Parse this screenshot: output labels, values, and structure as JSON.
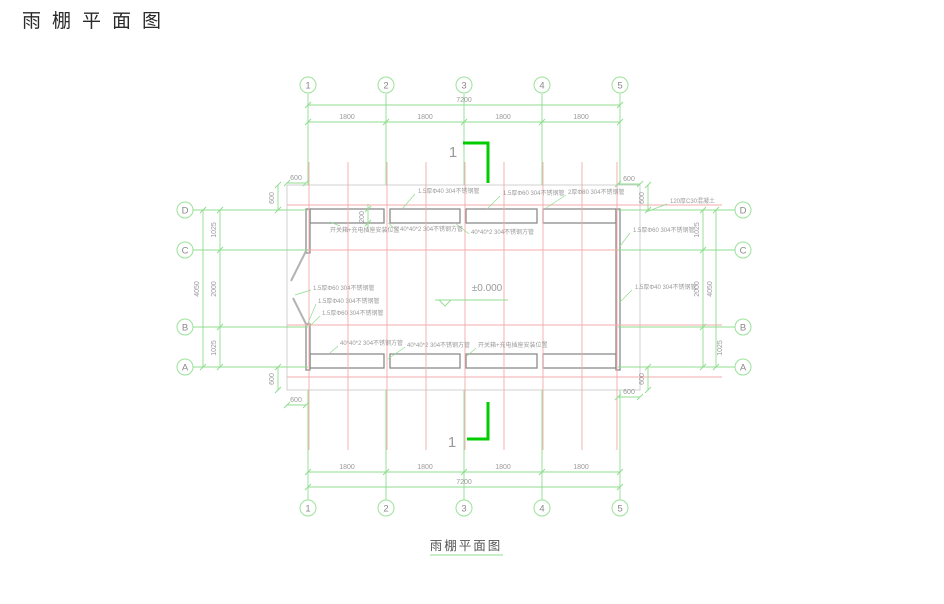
{
  "header": {
    "title": "雨棚平面图"
  },
  "footer": {
    "title": "雨棚平面图"
  },
  "plan": {
    "elevation": "±0.000",
    "section_label": "1"
  },
  "axes": {
    "cols": [
      "1",
      "2",
      "3",
      "4",
      "5"
    ],
    "rows": [
      "D",
      "C",
      "B",
      "A"
    ]
  },
  "dims": {
    "total_width": "7200",
    "bay": "1800",
    "total_depth": "4050",
    "edge": "600",
    "d1025": "1025",
    "d2000": "2000",
    "strip": "200"
  },
  "labels": {
    "pipe_40": "1.5厚Φ40  304不锈钢管",
    "pipe_60": "1.5厚Φ60  304不锈钢管",
    "pipe_80": "2厚Φ80  304不锈钢管",
    "concrete": "120厚C30混凝土",
    "square_tube": "40*40*2  304不锈钢方管",
    "switch_box": "开关箱+充电插座安装位置"
  },
  "colors": {
    "grid_green": "#8fdc8f",
    "grid_red": "#f3abab",
    "section_green": "#00cc00",
    "structure_gray": "#8c8c8c"
  }
}
